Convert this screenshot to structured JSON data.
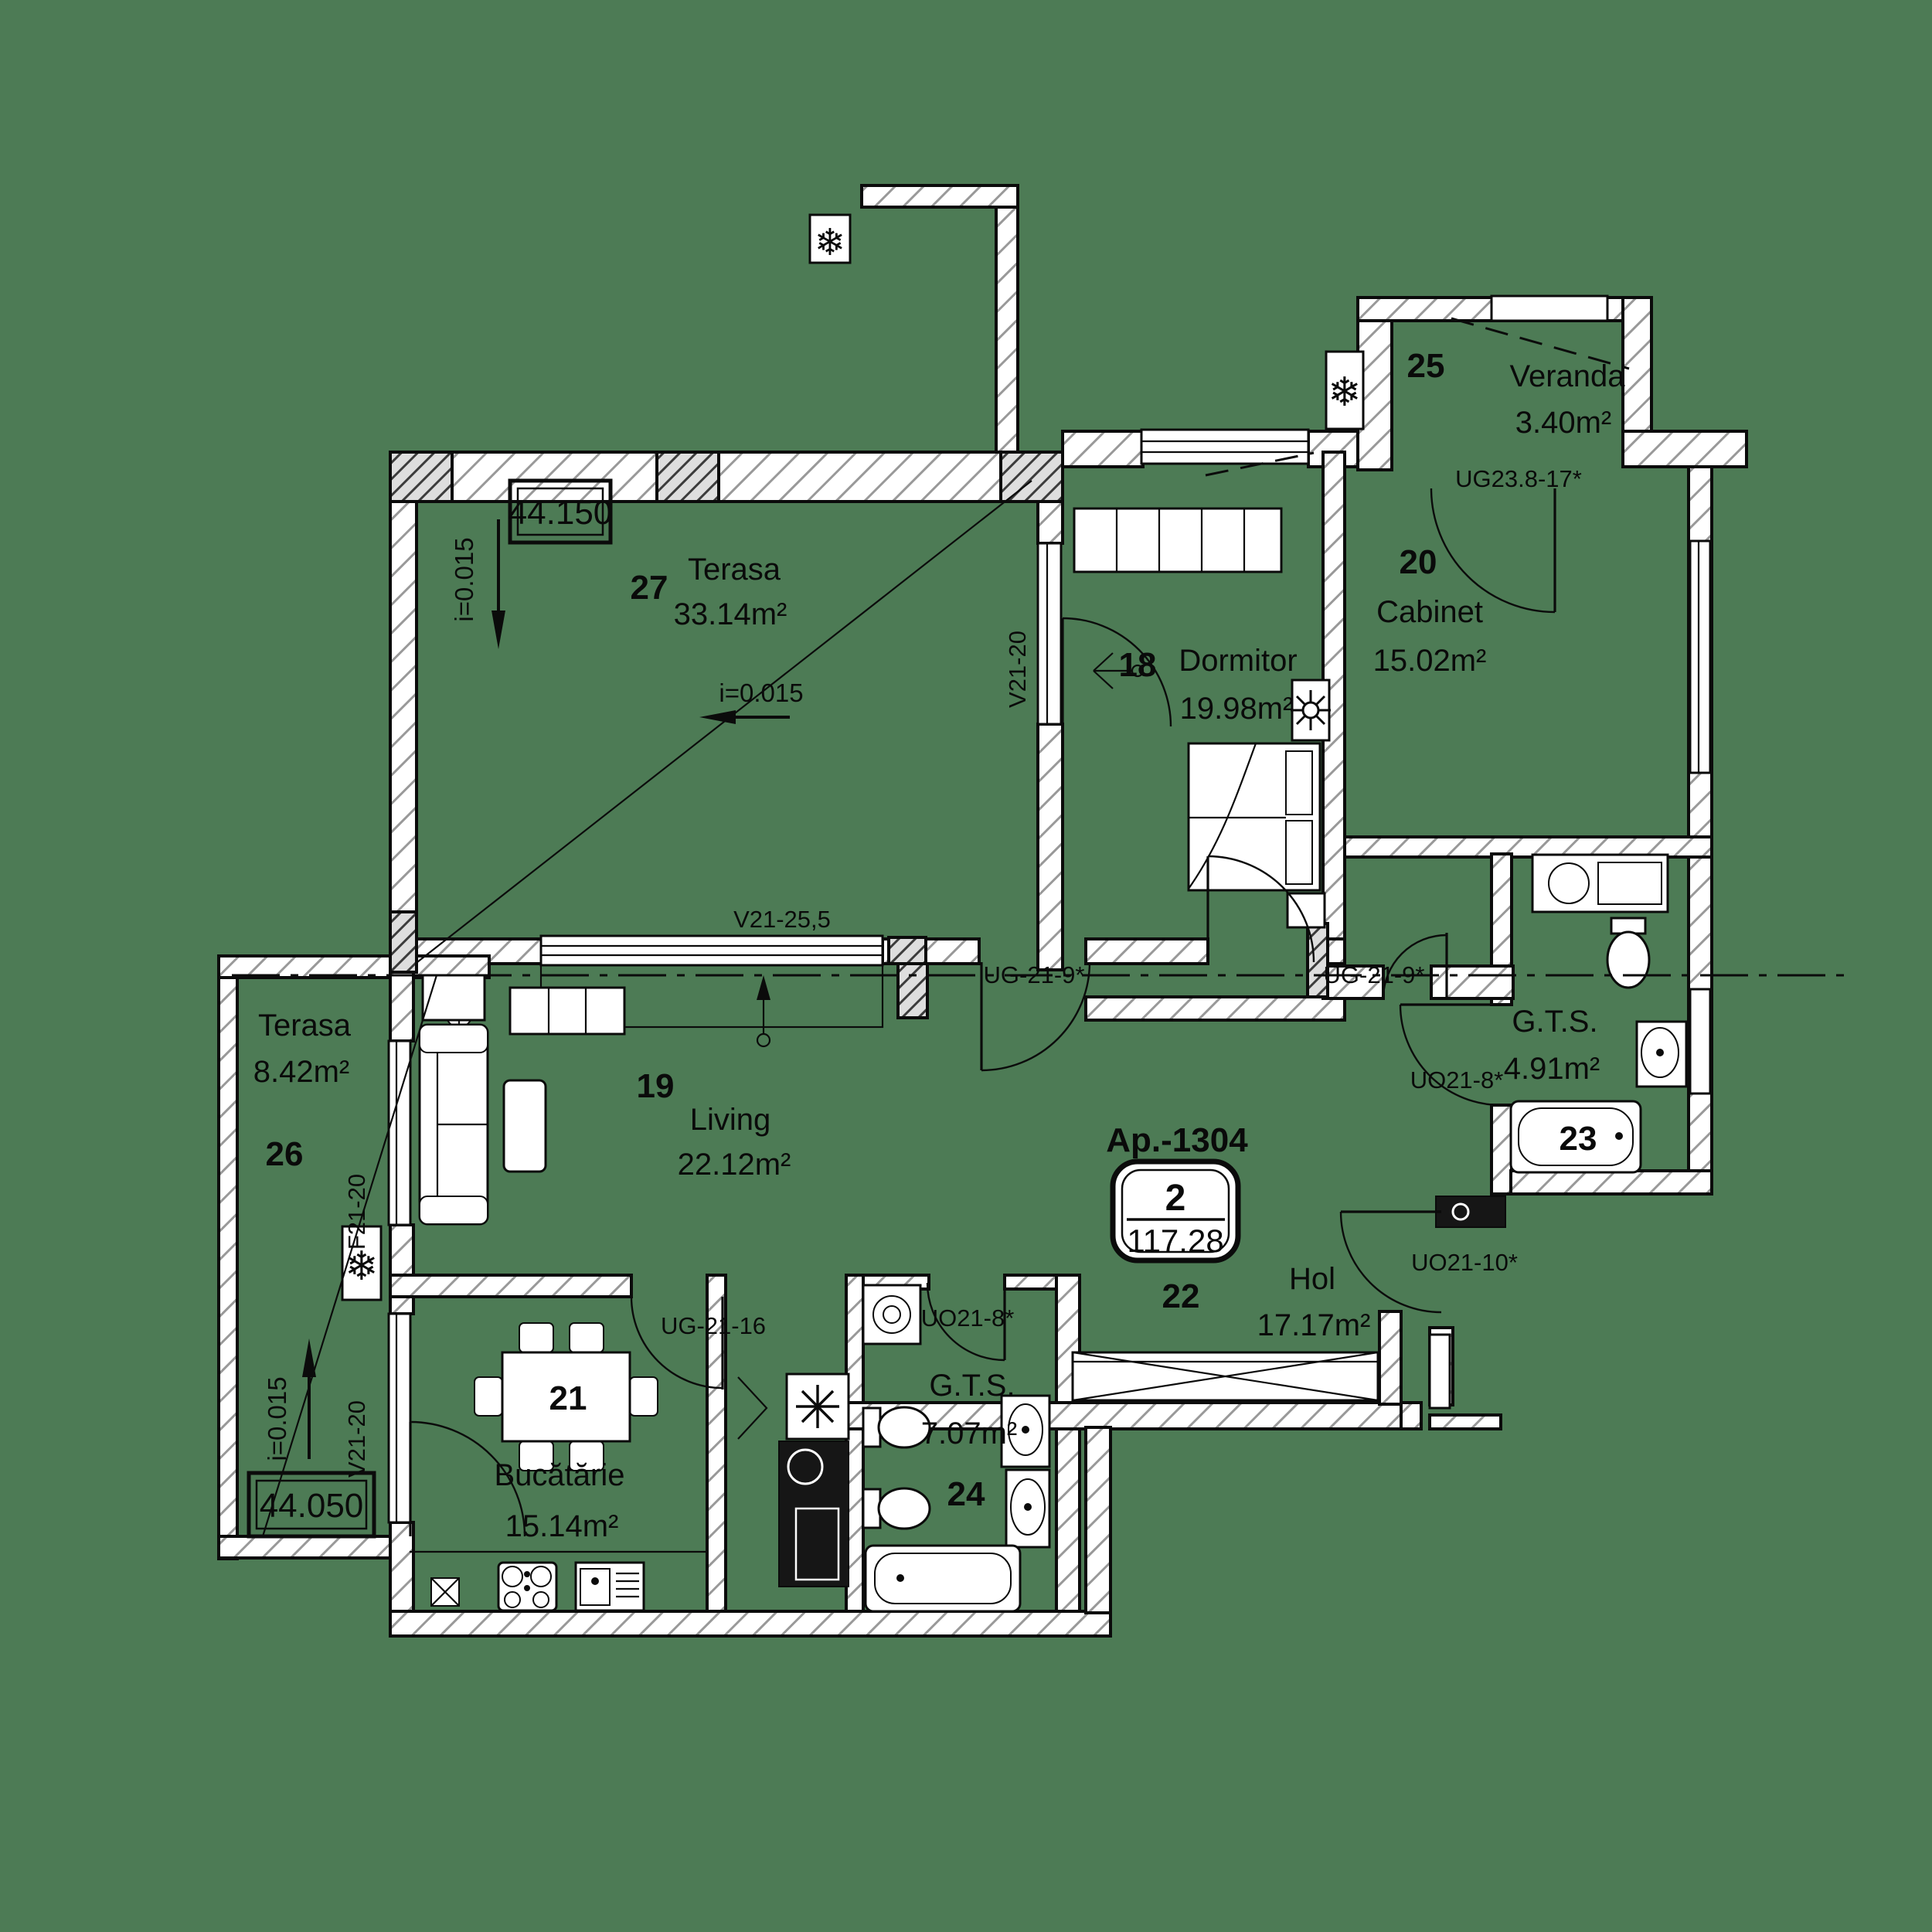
{
  "meta": {
    "type": "apartment floor plan",
    "background_color": "#4d7b55",
    "ink_color": "#0a0a0a"
  },
  "apartment": {
    "code": "Ap.-1304",
    "rooms_count": "2",
    "total_area": "117.28"
  },
  "rooms": [
    {
      "number": "27",
      "name": "Terasa",
      "area": "33.14m²"
    },
    {
      "number": "26",
      "name": "Terasa",
      "area": "8.42m²"
    },
    {
      "number": "25",
      "name": "Veranda",
      "area": "3.40m²"
    },
    {
      "number": "18",
      "name": "Dormitor",
      "area": "19.98m²"
    },
    {
      "number": "20",
      "name": "Cabinet",
      "area": "15.02m²"
    },
    {
      "number": "19",
      "name": "Living",
      "area": "22.12m²"
    },
    {
      "number": "22",
      "name": "Hol",
      "area": "17.17m²"
    },
    {
      "number": "21",
      "name": "Bucătărie",
      "area": "15.14m²"
    },
    {
      "number": "23",
      "name": "G.T.S.",
      "area": "4.91m²"
    },
    {
      "number": "24",
      "name": "G.T.S.",
      "area": "7.07m²"
    }
  ],
  "codes": {
    "v21_20_terrace": "V21-20",
    "v21_25_5": "V21-25,5",
    "f21_20": "F21-20",
    "v21_20_kitchen": "V21-20",
    "ug_21_16": "UG-21-16",
    "uo21_8_bath": "UO21-8*",
    "uo21_8_gts": "UO21-8*",
    "uo21_10": "UO21-10*",
    "ug_21_9_left": "UG-21-9*",
    "ug_21_9_right": "UG-21-9*",
    "ug23_8_17": "UG23.8-17*"
  },
  "levels": {
    "upper": "44.150",
    "lower": "44.050"
  },
  "slopes": {
    "terrace27_left": "i=0.015",
    "terrace27_mid": "i=0.015",
    "terrace26": "i=0.015"
  }
}
